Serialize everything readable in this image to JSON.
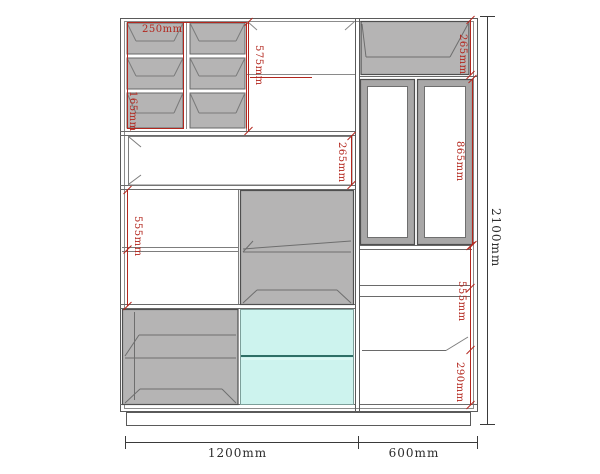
{
  "title": "Cabinet elevation drawing",
  "drawing": {
    "labels": {
      "shelf_col_width": "250mm",
      "shelf_cell_height": "165mm",
      "top_section_height": "575mm",
      "top_right_box_height": "265mm",
      "middle_open_height": "265mm",
      "door_height": "865mm",
      "left_lower_section_height": "555mm",
      "right_lower_section_height": "555mm",
      "right_bottom_height": "290mm",
      "total_height": "2100mm",
      "left_section_width": "1200mm",
      "right_section_width": "600mm"
    },
    "colors": {
      "dimension_accent": "#b3271e",
      "panel_gray": "#b5b4b4",
      "drawer_cyan": "#cdf3ee",
      "outline": "#5f5f5f"
    }
  }
}
